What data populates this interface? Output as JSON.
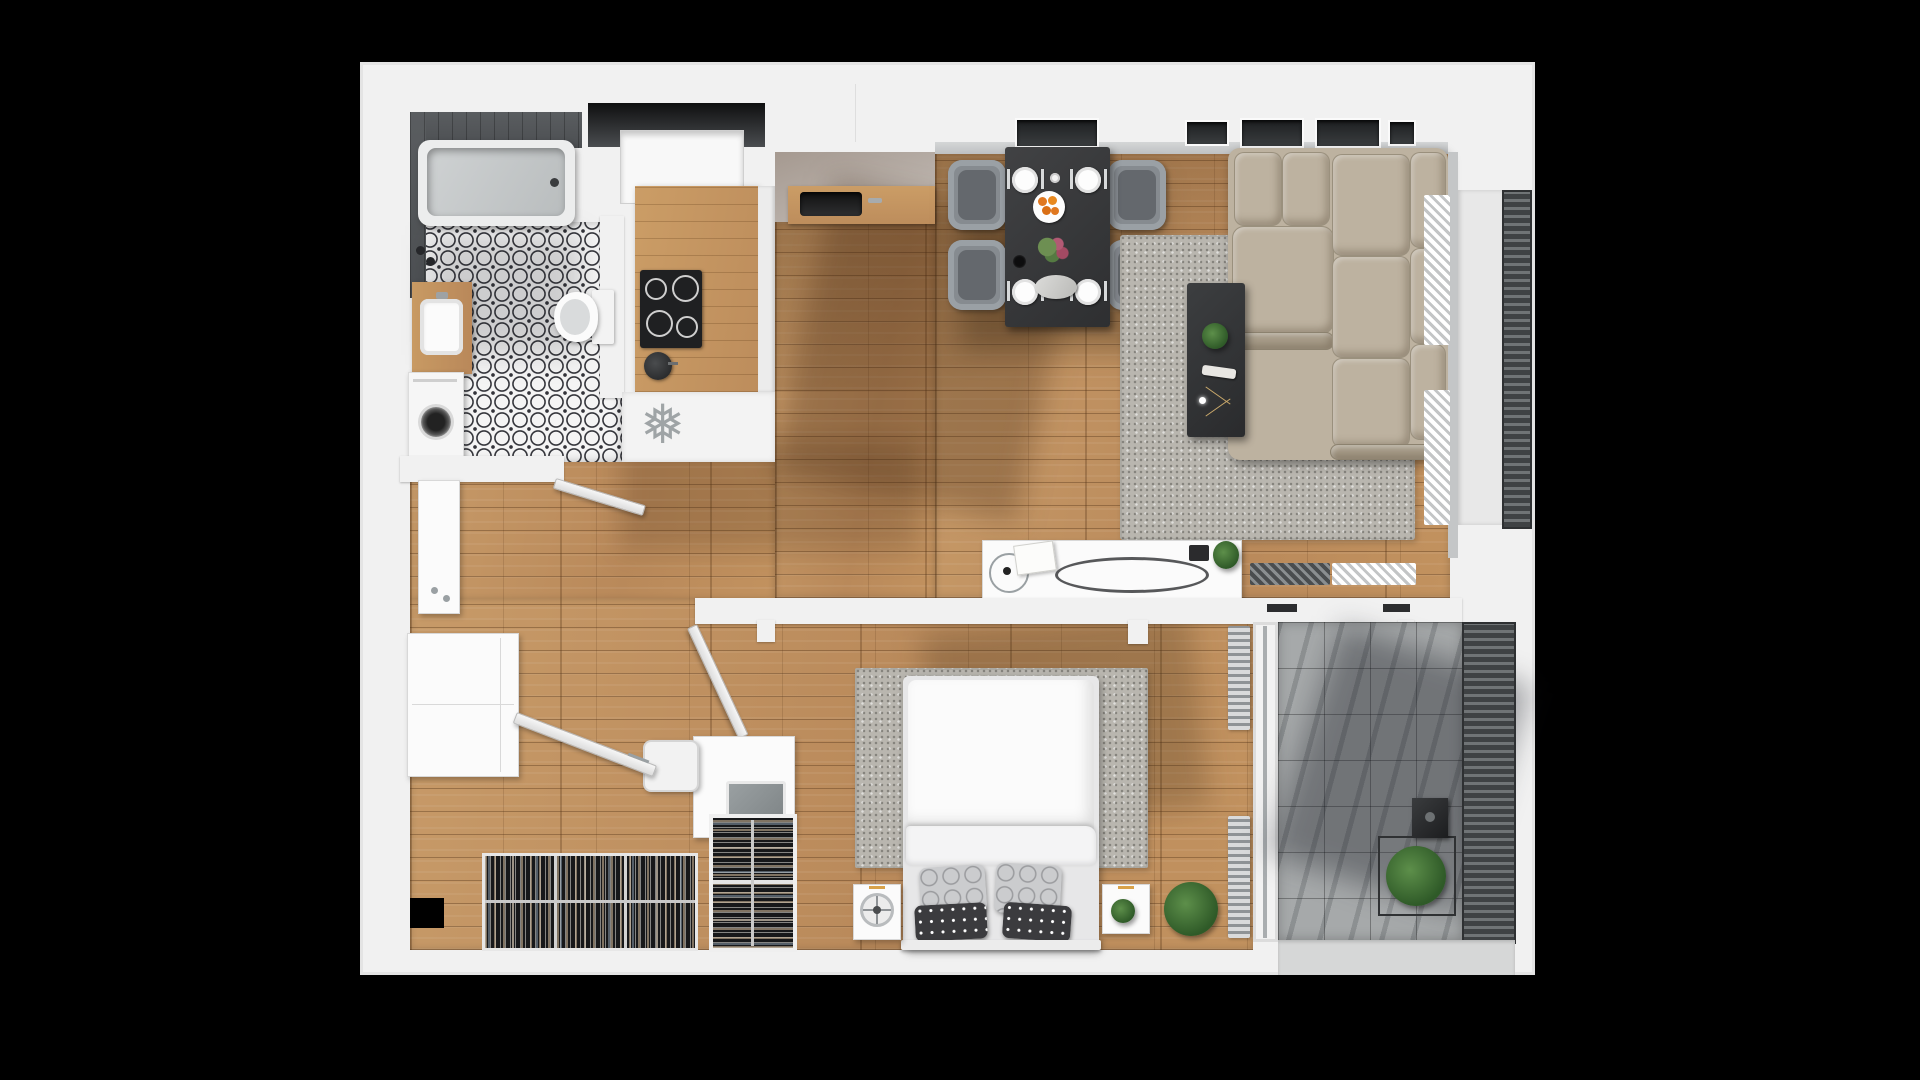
{
  "title": "3d-apartment-floor-plan-top-view",
  "background": "#000000",
  "palette": {
    "bg": "#000000",
    "wall": "#f1f1f1",
    "wall_shadow": "#d9d9d9",
    "wood_light": "#c79a68",
    "wood_dark": "#7d5636",
    "bath_tile_base": "#f4f4f4",
    "bath_tile_ink": "#33343a",
    "counter_wood": "#c79a63",
    "appliance_black": "#1f2022",
    "dining_table": "#3a3b3d",
    "chair_gray": "#868b90",
    "sofa_beige": "#bdb2a0",
    "rug_gray": "#b9b6af",
    "terrace_tile": "#a6a9aa",
    "railing_dark": "#3f4244",
    "bed_white": "#fbfbfb",
    "pillow_dark": "#3b3b3e",
    "plant_green": "#2f5a28",
    "accent_orange": "#e07820"
  },
  "icons": {
    "fridge": "❅"
  },
  "rooms": [
    {
      "name": "bathroom",
      "items": [
        "bathtub",
        "vanity-sink",
        "toilet",
        "washing-machine",
        "patterned-tile-floor",
        "dark-tile-wall",
        "bathroom-door"
      ]
    },
    {
      "name": "kitchen",
      "items": [
        "window-niche",
        "wood-counter",
        "cooktop-4-burners",
        "kettle",
        "sink",
        "fridge-spot-snowflake",
        "upper-cabinets"
      ]
    },
    {
      "name": "dining-area",
      "items": [
        "dark-dining-table",
        "four-gray-chairs",
        "four-place-settings",
        "fruit-plate",
        "flower-vase",
        "serving-tray",
        "windows"
      ]
    },
    {
      "name": "living-room",
      "items": [
        "beige-corner-sofa",
        "shaggy-gray-rug",
        "dark-coffee-table",
        "white-console-with-mirror-and-decor",
        "radiator",
        "vertical-blinds"
      ]
    },
    {
      "name": "bedroom",
      "items": [
        "double-bed-white-duvet",
        "patterned-pillows",
        "two-nightstands",
        "table-fan",
        "desk-with-laptop",
        "chair",
        "potted-plants",
        "radiators",
        "bedroom-door",
        "tall-wardrobe"
      ]
    },
    {
      "name": "hallway-closet",
      "items": [
        "entrance-door",
        "entry-cabinet",
        "closet-column",
        "open-hanging-racks"
      ]
    },
    {
      "name": "balcony-east",
      "items": [
        "railing",
        "deck"
      ]
    },
    {
      "name": "terrace-south",
      "items": [
        "concrete-tiles",
        "caged-plant",
        "lantern-box",
        "railing"
      ]
    }
  ]
}
